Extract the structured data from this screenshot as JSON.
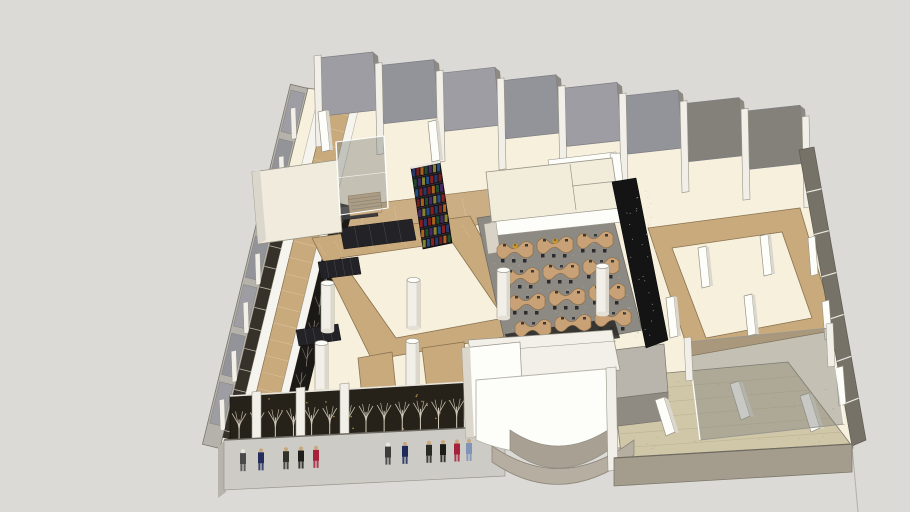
{
  "scene": {
    "name": "sketchup-style-3d-floorplan-model",
    "background": "#dbdad6",
    "palette": {
      "background": "#dbdad6",
      "floor": "#f7f0dd",
      "floorEdge": "#8b877e",
      "wood": "#c9aa7d",
      "woodLight": "#dcc49c",
      "woodDark": "#8a7350",
      "woodPatch": "#ccae85",
      "panel": "#9d9da3",
      "panelAlt": "#93939a",
      "panelDark": "#84817a",
      "post": "#f1efe8",
      "postEdge": "#989588",
      "leftBand": "#b5b2ab",
      "rightWall": "#767268",
      "rightWallLight": "#8a867d",
      "cream": "#f2ecdb",
      "white": "#f6f4ee",
      "whiteBright": "#fdfdfa",
      "shade": "#dbd7cc",
      "carpet": "#8d8983",
      "carpetDot": "#a7a49d",
      "carpetFront": "#2f2d29",
      "desk": "#c8a276",
      "deskEdge": "#8a6b45",
      "chair": "#2c2c2e",
      "dark": "#232226",
      "counter": "#3b3b3d",
      "screenDark": "#262219",
      "branch": "#d6cfbf",
      "goldDot": "#bd9a4d",
      "glass": "rgba(126,129,123,0.42)",
      "glassEdge": "#9a978e",
      "terrace": "#d0c7a9",
      "terraceLine": "#bdb493",
      "terraceWall": "#a49d8d",
      "frontWall": "#cdcbc5",
      "frontWallDark": "#b7b4ad",
      "stepBand": "#b6aea0",
      "greige": "#a8a193",
      "gold": "#c9992c",
      "outline": "#7a766d",
      "black": "#141414"
    }
  },
  "back_wall": {
    "panel_count": 8
  },
  "left_wall": {
    "panel_count": 7
  },
  "people": {
    "skin": "#c9a87c",
    "group1": [
      "#4a4a4a",
      "#232d5e",
      "#33322a",
      "#1f1f1c",
      "#a8213a"
    ],
    "group2": [
      "#3c3c3c",
      "#20295c",
      "#2a2a24",
      "#1c1c18",
      "#a8213a",
      "#8093b8"
    ]
  },
  "classroom": {
    "rows": 4,
    "desks_per_row": 3,
    "chairs_per_desk": 3,
    "gold_items_on_back_row": 2
  },
  "bookshelf": {
    "rows": 8,
    "cols": 7,
    "book_colors": [
      "#2b3a6b",
      "#7a1f1f",
      "#b5651d",
      "#1f4f2e",
      "#4a2a6b",
      "#8a8a30",
      "#24518a",
      "#902020"
    ]
  },
  "facade_screen": {
    "tree_count": 15,
    "gold_dot_count": 28
  }
}
